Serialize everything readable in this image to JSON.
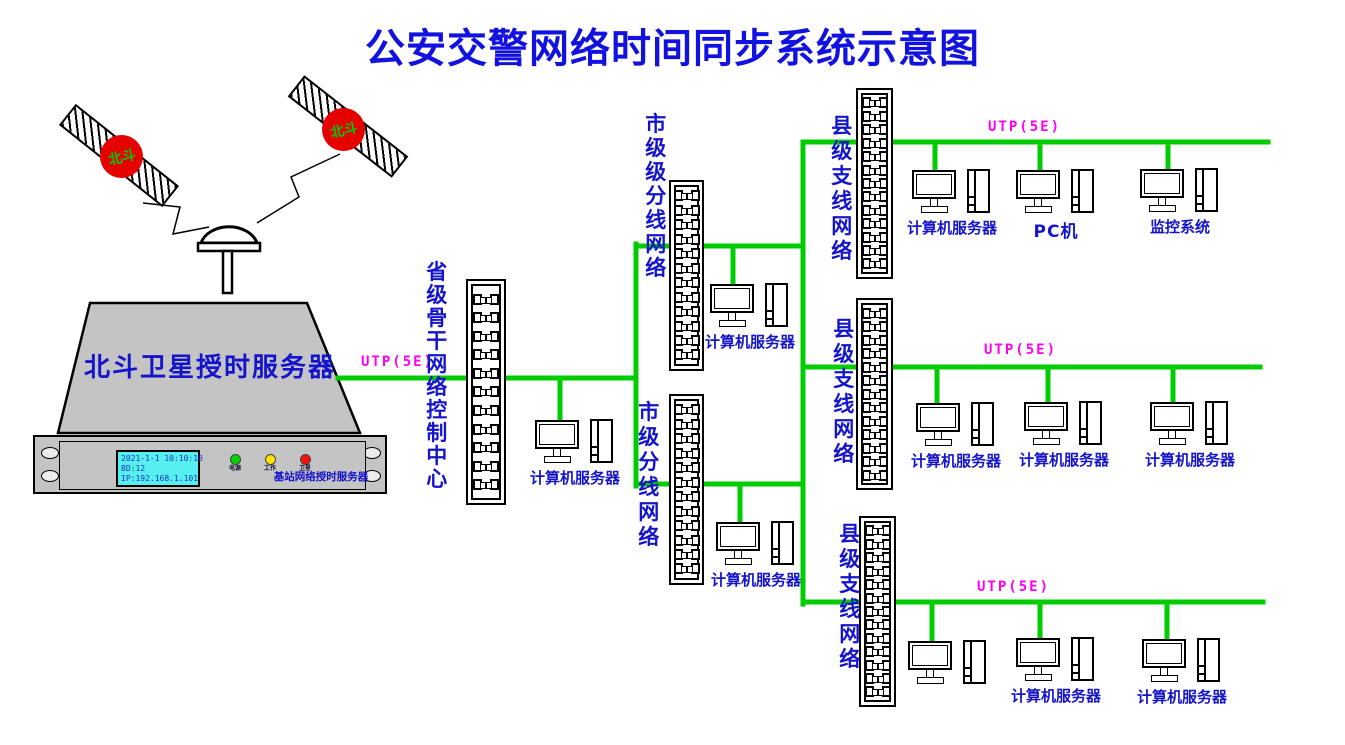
{
  "title": "公安交警网络时间同步系统示意图",
  "palette": {
    "line_green": "#00CC00",
    "title_blue": "#1212E0",
    "label_blue": "#1414CC",
    "utp_magenta": "#FF00F0",
    "satellite_red": "#E60000",
    "satellite_text_green": "#00CC00",
    "chassis_gray": "#C4C4C4",
    "lcd_cyan": "#55EFEF"
  },
  "satellites": [
    {
      "label": "北斗"
    },
    {
      "label": "北斗"
    }
  ],
  "timing_server": {
    "name": "北斗卫星授时服务器",
    "model_label": "基站网络授时服务器",
    "lcd": {
      "line1": "2021-1-1 10:10:10",
      "line2": "BD:12",
      "line3": "IP:192.168.1.101"
    },
    "leds": [
      {
        "label": "电源",
        "color": "#00D800"
      },
      {
        "label": "工作",
        "color": "#FFE400"
      },
      {
        "label": "卫星",
        "color": "#FF1010"
      }
    ]
  },
  "utp_label": "UTP(5E)",
  "network": {
    "provincial": {
      "label": "省级骨干网络控制中心",
      "server_label": "计算机服务器"
    },
    "municipal_1": {
      "label": "市级级分线网络",
      "server_label": "计算机服务器"
    },
    "municipal_2": {
      "label": "市级分线网络",
      "server_label": "计算机服务器"
    },
    "county_1": {
      "label": "县级支线网络",
      "devices": [
        "计算机服务器",
        "PC机",
        "监控系统"
      ]
    },
    "county_2": {
      "label": "县级支线网络",
      "devices": [
        "计算机服务器",
        "计算机服务器",
        "计算机服务器"
      ]
    },
    "county_3": {
      "label": "县级支线网络",
      "devices": [
        "",
        "计算机服务器",
        "计算机服务器"
      ]
    }
  }
}
